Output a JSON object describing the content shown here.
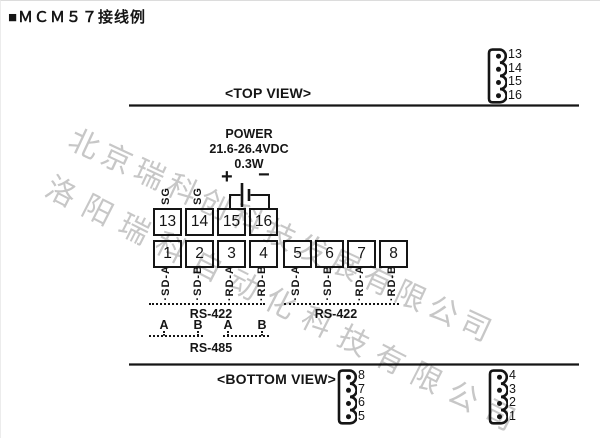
{
  "title": "■ＭＣＭ５７接线例",
  "views": {
    "top": "<TOP VIEW>",
    "bottom": "<BOTTOM VIEW>"
  },
  "power": {
    "name": "POWER",
    "voltage": "21.6-26.4VDC",
    "wattage": "0.3W",
    "plus": "+",
    "minus": "−"
  },
  "connectors": {
    "top_right": {
      "pins": [
        "13",
        "14",
        "15",
        "16"
      ]
    },
    "bottom_left": {
      "pins": [
        "8",
        "7",
        "6",
        "5"
      ]
    },
    "bottom_right": {
      "pins": [
        "4",
        "3",
        "2",
        "1"
      ]
    }
  },
  "terminal_rows": {
    "upper": [
      "13",
      "14",
      "15",
      "16"
    ],
    "lower": [
      "1",
      "2",
      "3",
      "4",
      "5",
      "6",
      "7",
      "8"
    ],
    "sg": [
      "SG",
      "SG"
    ],
    "signals": [
      "SD-A",
      "SD-B",
      "RD-A",
      "RD-B",
      "SD-A",
      "SD-B",
      "RD-A",
      "RD-B"
    ]
  },
  "buses": {
    "rs422_left": "RS-422",
    "rs422_right": "RS-422",
    "rs485": "RS-485",
    "ab": [
      "A",
      "B",
      "A",
      "B"
    ]
  },
  "watermarks": {
    "line1": "北京瑞科创科技发展有限公司",
    "line2": "洛阳瑞科自动化科技有限公司"
  },
  "colors": {
    "ink": "#151515",
    "watermark": "#c7c7c7"
  }
}
